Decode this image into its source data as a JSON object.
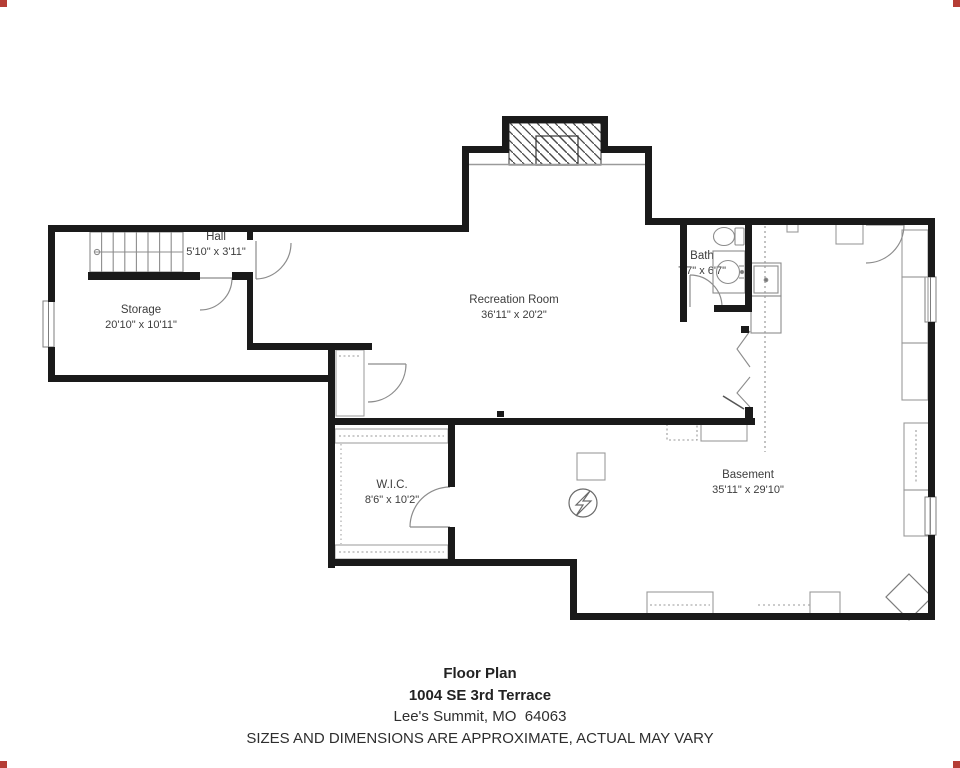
{
  "plan": {
    "rooms": [
      {
        "name": "Hall",
        "dims": "5'10\" x 3'11\""
      },
      {
        "name": "Storage",
        "dims": "20'10\" x 10'11\""
      },
      {
        "name": "Recreation Room",
        "dims": "36'11\" x 20'2\""
      },
      {
        "name": "Bath",
        "dims": "7'7\" x 6'7\""
      },
      {
        "name": "W.I.C.",
        "dims": "8'6\" x 10'2\""
      },
      {
        "name": "Basement",
        "dims": "35'11\" x 29'10\""
      }
    ],
    "symbols": [
      "stairs",
      "fireplace-hatch",
      "door-swing",
      "window",
      "toilet",
      "sink-vanity",
      "utility-sink",
      "electrical-panel",
      "support-post-diamond",
      "closet-shelves"
    ]
  },
  "footer": {
    "title": "Floor Plan",
    "address": "1004 SE 3rd Terrace",
    "city": "Lee's Summit, MO  64063",
    "disclaimer": "SIZES AND DIMENSIONS ARE APPROXIMATE, ACTUAL MAY VARY"
  },
  "colors": {
    "wall": "#1a1a1a",
    "fixture_line": "#8c8c8c",
    "corner_mark": "#b53d35",
    "text": "#3d3d3d"
  }
}
